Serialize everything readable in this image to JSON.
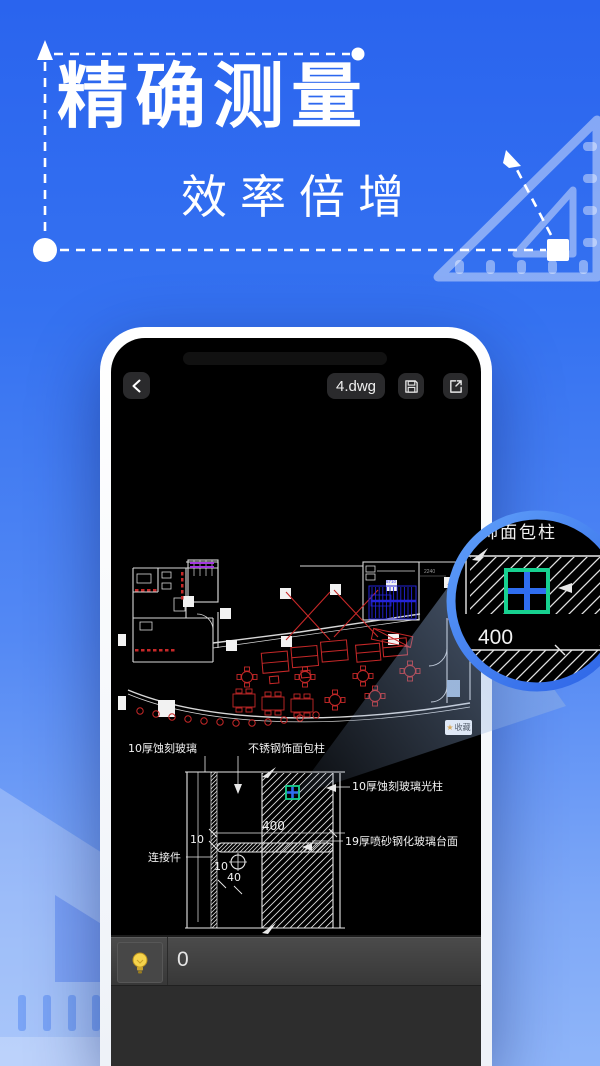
{
  "hero": {
    "title": "精确测量",
    "subtitle": "效率倍增"
  },
  "viewer": {
    "filename": "4.dwg",
    "favorite": {
      "star": "★",
      "label": "收藏"
    },
    "statusbar": {
      "value": "0"
    }
  },
  "cad": {
    "plan": {
      "dim_top": "2240",
      "dim_stairs": "5710"
    },
    "detail": {
      "label_glass": "10厚蚀刻玻璃",
      "label_column": "不锈钢饰面包柱",
      "label_light_column": "10厚蚀刻玻璃光柱",
      "label_table": "19厚喷砂钢化玻璃台面",
      "label_connector": "连接件",
      "dim_400": "400",
      "dim_10_a": "10",
      "dim_10_b": "10",
      "dim_40": "40"
    },
    "magnifier": {
      "partial_label": "钢饰面包柱",
      "dim": "400"
    }
  },
  "icons": {
    "back": "chevron-left",
    "save": "floppy-disk",
    "share": "export-arrow",
    "favorite": "star",
    "hint": "lightbulb",
    "measure_arrow": "dashed-arrow",
    "ruler": "set-square-triangle"
  },
  "colors": {
    "accent_blue": "#2f6df0",
    "magnifier_ring": "#3f80f2",
    "cad_red": "#c8302a",
    "cad_blue": "#2424d8",
    "cad_purple": "#a43ae0",
    "highlight_green": "#17d190",
    "bulb_yellow": "#f6d44c"
  }
}
